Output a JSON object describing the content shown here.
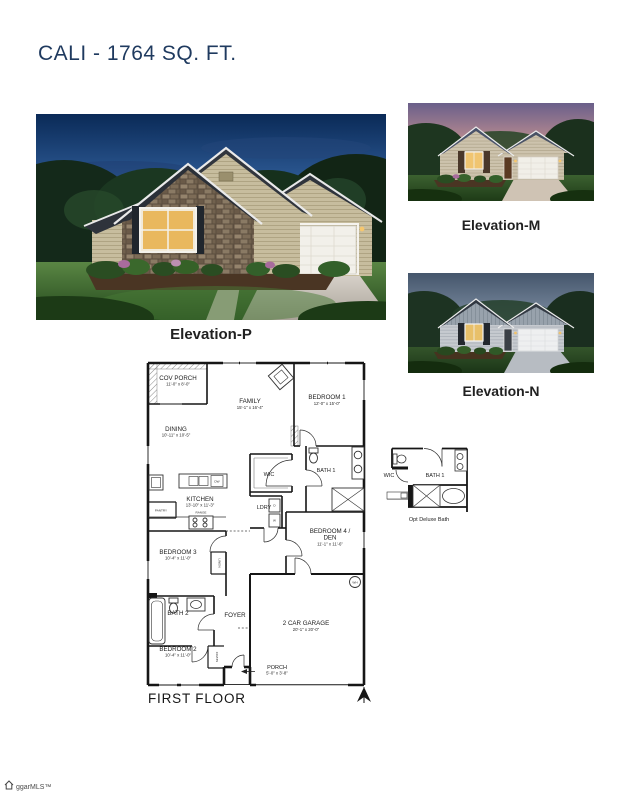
{
  "page": {
    "title": "CALI - 1764 SQ. FT."
  },
  "colors": {
    "title_navy": "#1f3a5f",
    "plan_walls": "#161616",
    "label_dark": "#212121"
  },
  "elevations": {
    "main": {
      "label": "Elevation-P"
    },
    "m": {
      "label": "Elevation-M"
    },
    "n": {
      "label": "Elevation-N"
    }
  },
  "floor_plan": {
    "caption": "FIRST FLOOR",
    "rooms": {
      "cov_porch": {
        "label": "COV PORCH",
        "dims": "11'-0\" x 8'-0\""
      },
      "dining": {
        "label": "DINING",
        "dims": "10'-11\" x 10'-5\""
      },
      "family": {
        "label": "FAMILY",
        "dims": "15'-1\" x 16'-4\""
      },
      "bedroom1": {
        "label": "BEDROOM 1",
        "dims": "12'-0\" x 15'-0\""
      },
      "wic": {
        "label": "WIC"
      },
      "bath1": {
        "label": "BATH 1"
      },
      "kitchen": {
        "label": "KITCHEN",
        "dims": "13'-10\" x 11'-3\""
      },
      "ldry": {
        "label": "LDRY"
      },
      "bedroom4": {
        "label_line1": "BEDROOM 4 /",
        "label_line2": "DEN",
        "dims": "11'-1\" x 11'-6\""
      },
      "bedroom3": {
        "label": "BEDROOM 3",
        "dims": "10'-4\" x 11'-0\""
      },
      "bath2": {
        "label": "BATH 2"
      },
      "foyer": {
        "label": "FOYER"
      },
      "garage": {
        "label": "2 CAR GARAGE",
        "dims": "20'-1\" x 20'-0\""
      },
      "bedroom2": {
        "label": "BEDROOM 2",
        "dims": "10'-4\" x 11'-0\""
      },
      "porch": {
        "label": "PORCH",
        "dims": "5'-0\" x 3'-8\""
      }
    },
    "fixtures": {
      "pantry": "PANTRY",
      "range": "RANGE",
      "dw": "DW",
      "dryer": "D",
      "washer": "W",
      "linen": "LINEN",
      "coats": "COATS",
      "water_heater": "WH"
    }
  },
  "opt_bath": {
    "wic": "WIC",
    "bath": "BATH 1",
    "caption": "Opt Deluxe Bath"
  },
  "footer": {
    "logo_text": "ggarMLS™"
  }
}
